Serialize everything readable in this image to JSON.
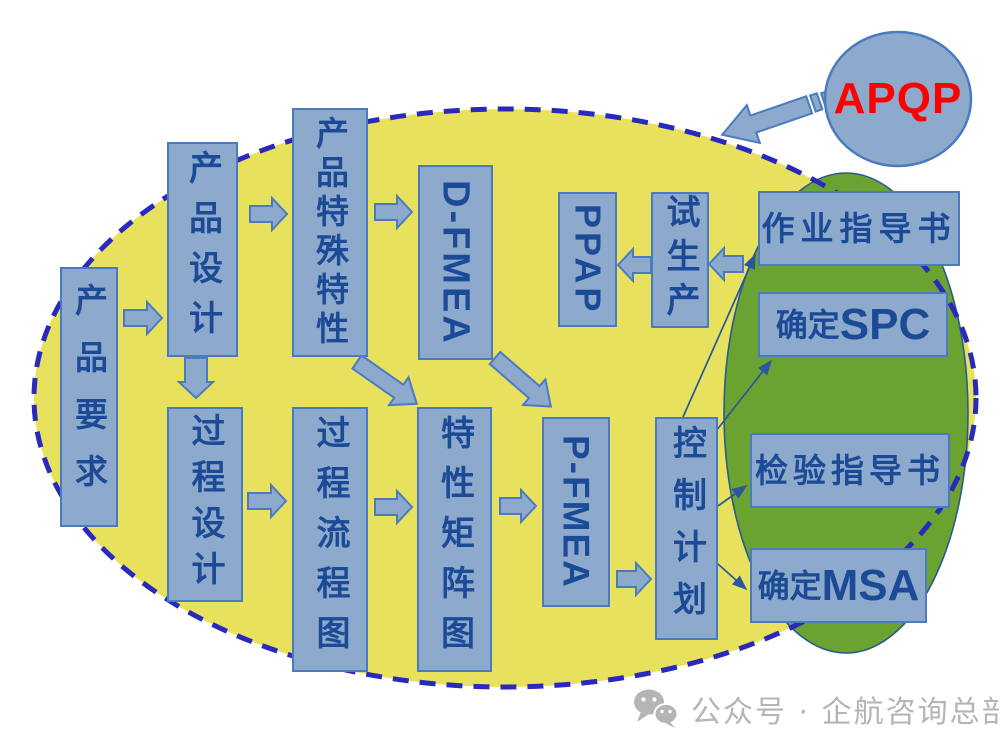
{
  "badge": {
    "label": "APQP"
  },
  "nodes": {
    "product_requirements": "产品要求",
    "product_design": "产品设计",
    "product_special_characteristics": "产品特殊特性",
    "d_fmea": "D-FMEA",
    "ppap": "PPAP",
    "trial_production": "试生产",
    "work_instructions": "作业指导书",
    "determine_spc": {
      "cn": "确定",
      "en": "SPC"
    },
    "process_design": "过程设计",
    "process_flow_diagram": "过程流程图",
    "characteristics_matrix_diagram": "特性矩阵图",
    "p_fmea": "P-FMEA",
    "control_plan": "控制计划",
    "inspection_instructions": "检验指导书",
    "determine_msa": {
      "cn": "确定",
      "en": "MSA"
    }
  },
  "colors": {
    "yellow": "#e8e15e",
    "green": "#6aa32f",
    "box_fill": "#8da9cc",
    "box_border": "#4a7bc0",
    "ink": "#1b4b96",
    "dash": "#2929bd",
    "red": "#ff0000",
    "thin": "#2b56a0",
    "gray": "#b5b5b5"
  },
  "watermark": {
    "icon": "wechat-icon",
    "text": "公众号 · 企航咨询总部"
  }
}
